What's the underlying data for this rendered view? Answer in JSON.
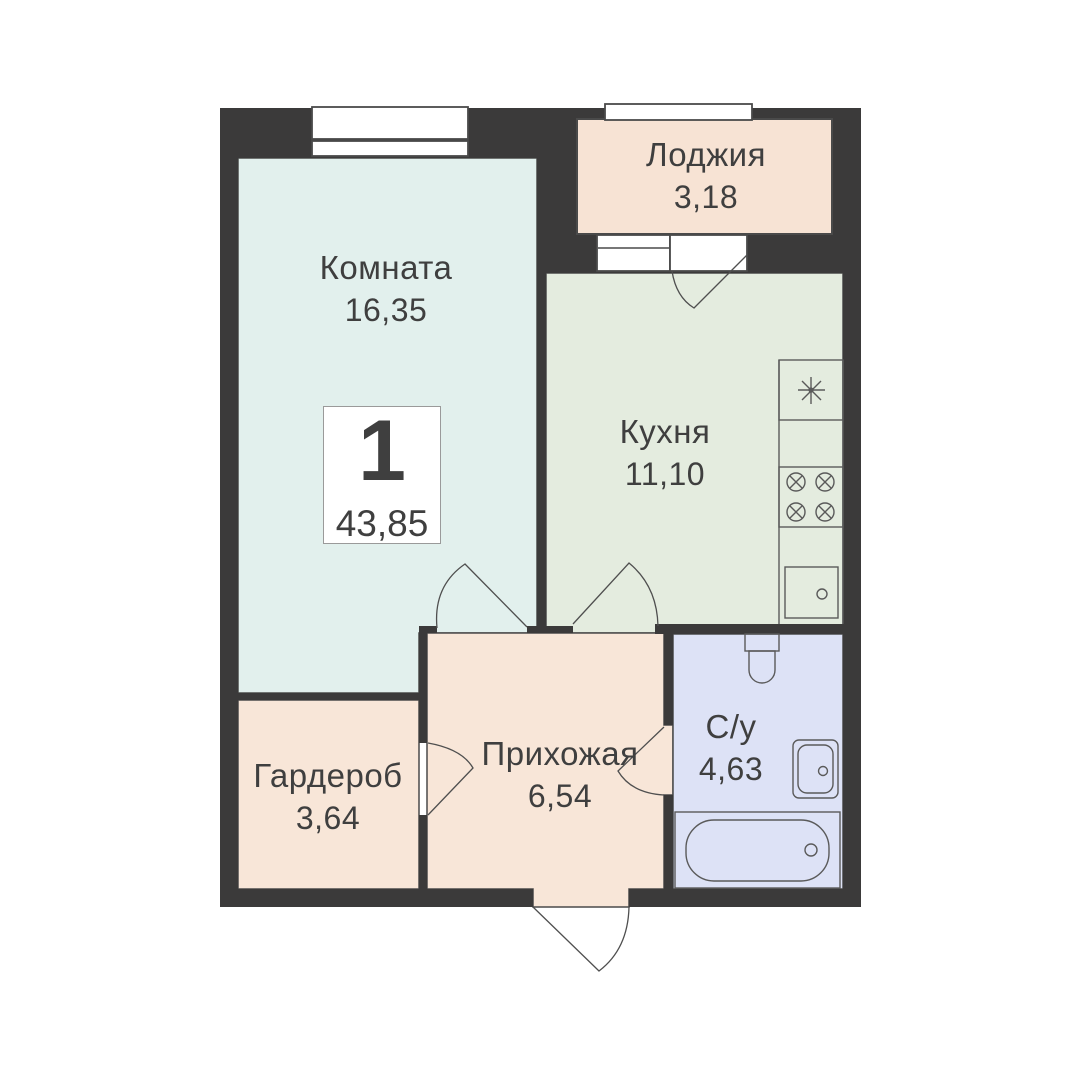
{
  "floorplan": {
    "unit": {
      "rooms_count": "1",
      "total_area": "43,85"
    },
    "rooms": [
      {
        "id": "living",
        "name": "Комната",
        "area": "16,35"
      },
      {
        "id": "loggia",
        "name": "Лоджия",
        "area": "3,18"
      },
      {
        "id": "kitchen",
        "name": "Кухня",
        "area": "11,10"
      },
      {
        "id": "wardrobe",
        "name": "Гардероб",
        "area": "3,64"
      },
      {
        "id": "hallway",
        "name": "Прихожая",
        "area": "6,54"
      },
      {
        "id": "bathroom",
        "name": "С/у",
        "area": "4,63"
      }
    ],
    "colors": {
      "wall": "#3b3a3a",
      "room-living": "#e2f0ed",
      "room-kitchen": "#e4ecdf",
      "room-peach": "#f8e6d8",
      "room-loggia": "#f7e3d4",
      "room-bathroom": "#dde2f6",
      "stroke": "#4a4a4a",
      "fixture": "#5a5a5a",
      "door": "#4f4f4f",
      "text": "#3f3f3f"
    }
  }
}
